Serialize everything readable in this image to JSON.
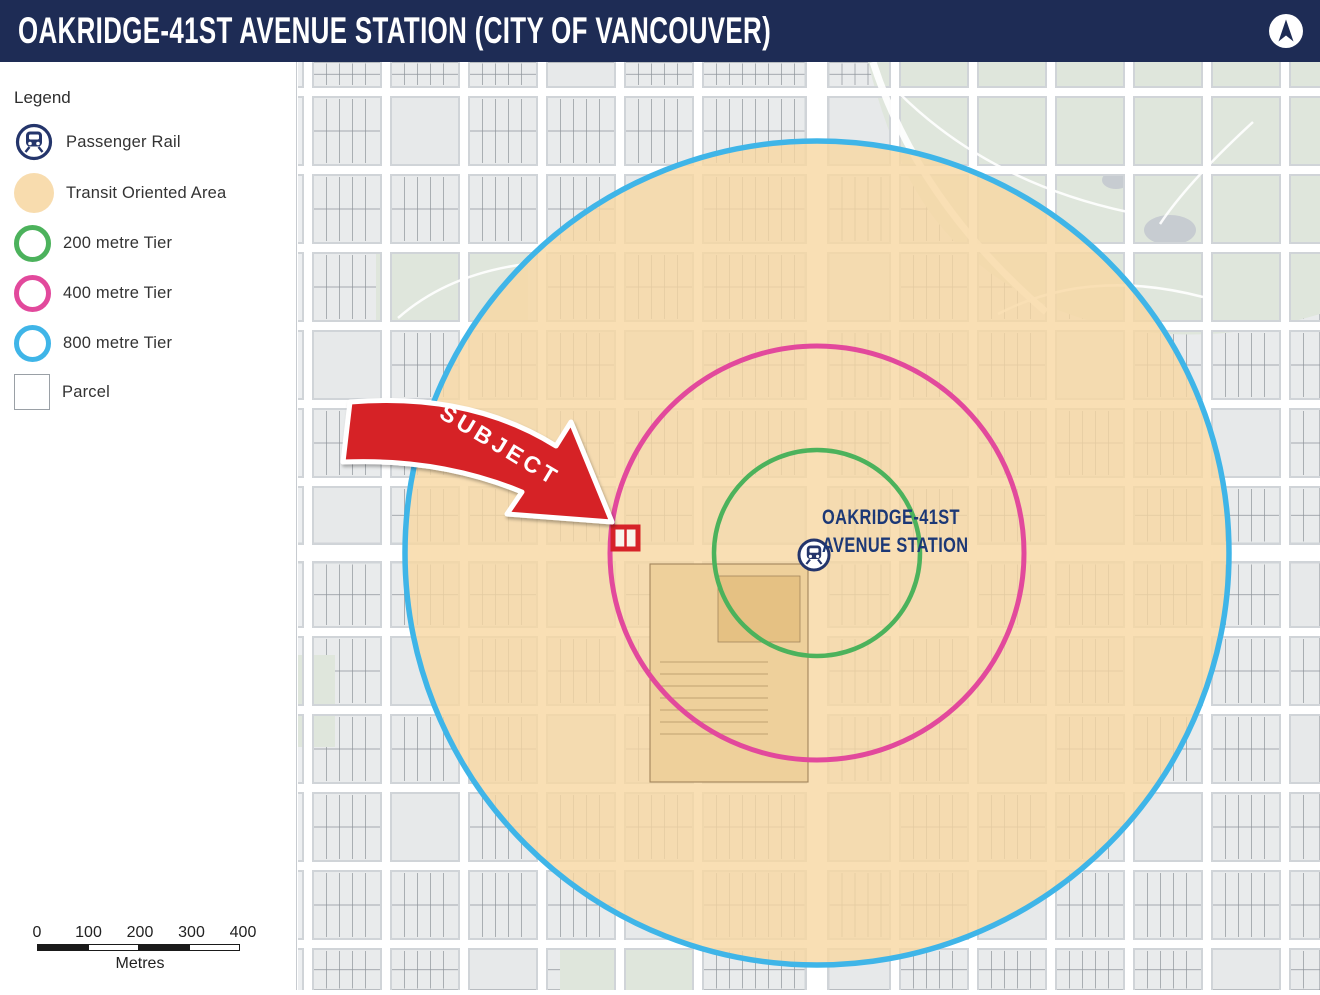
{
  "header": {
    "title": "OAKRIDGE-41ST AVENUE STATION (CITY OF VANCOUVER)"
  },
  "north_arrow": {
    "icon": "north-arrow-icon",
    "color": "#1e2c55"
  },
  "legend": {
    "title": "Legend",
    "items": [
      {
        "id": "passenger-rail",
        "label": "Passenger Rail",
        "color": "#24356b"
      },
      {
        "id": "transit-oriented-area",
        "label": "Transit Oriented Area",
        "color": "#f8dcae"
      },
      {
        "id": "tier-200",
        "label": "200 metre Tier",
        "color": "#4cb25c"
      },
      {
        "id": "tier-400",
        "label": "400 metre Tier",
        "color": "#e2499c"
      },
      {
        "id": "tier-800",
        "label": "800 metre Tier",
        "color": "#3fb5e8"
      },
      {
        "id": "parcel",
        "label": "Parcel",
        "color": "#9aa0a6"
      }
    ]
  },
  "map": {
    "station_label_line1": "OAKRIDGE-41ST",
    "station_label_line2": "AVENUE STATION",
    "station_label_color": "#1c3876",
    "subject_label": "SUBJECT",
    "subject_color": "#d62228",
    "toa_fill": "#f7d7a1",
    "tiers": [
      {
        "label": "200 metre Tier",
        "radius_metres": 200,
        "color": "#4cb25c"
      },
      {
        "label": "400 metre Tier",
        "radius_metres": 400,
        "color": "#e2499c"
      },
      {
        "label": "800 metre Tier",
        "radius_metres": 800,
        "color": "#3fb5e8"
      }
    ]
  },
  "scalebar": {
    "ticks": [
      "0",
      "100",
      "200",
      "300",
      "400"
    ],
    "unit": "Metres"
  }
}
